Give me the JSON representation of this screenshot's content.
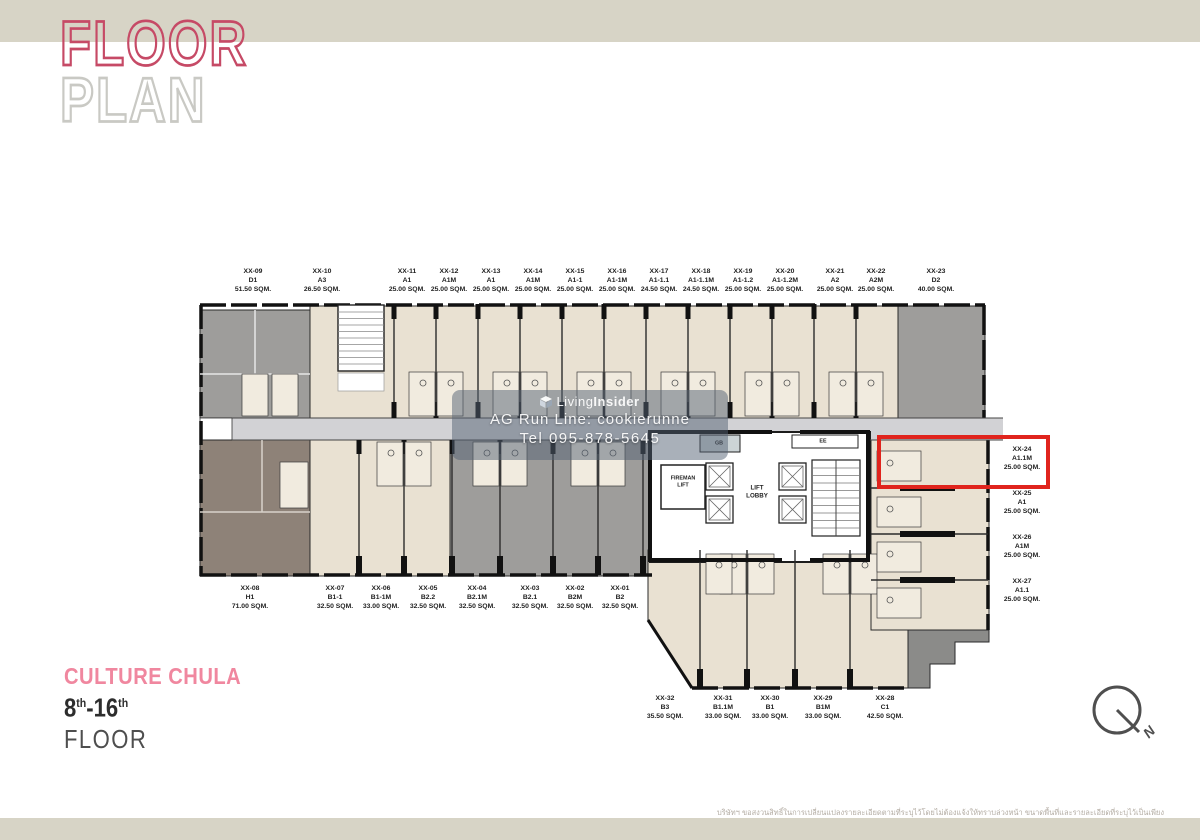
{
  "header": {
    "title_line1": "FLOOR",
    "title_line2": "PLAN"
  },
  "project": {
    "name": "CULTURE CHULA",
    "floor_from": "8",
    "floor_from_sup": "th",
    "floor_to": "-16",
    "floor_to_sup": "th",
    "floor_word": "FLOOR"
  },
  "watermark": {
    "brand_prefix": "Living",
    "brand_suffix": "Insider",
    "line2": "AG Run Line: cookierunne",
    "line3": "Tel 095-878-5645"
  },
  "compass": {
    "label": "N"
  },
  "core": {
    "gb": "GB",
    "ee": "EE",
    "fireman_line1": "FIREMAN",
    "fireman_line2": "LIFT",
    "lobby_line1": "LIFT",
    "lobby_line2": "LOBBY"
  },
  "highlight": {
    "unit": "XX-24",
    "color": "#e0241d"
  },
  "units": {
    "top": [
      {
        "id": "XX-09",
        "type": "D1",
        "area": "51.50 SQM."
      },
      {
        "id": "XX-10",
        "type": "A3",
        "area": "26.50 SQM."
      },
      {
        "id": "XX-11",
        "type": "A1",
        "area": "25.00 SQM."
      },
      {
        "id": "XX-12",
        "type": "A1M",
        "area": "25.00 SQM."
      },
      {
        "id": "XX-13",
        "type": "A1",
        "area": "25.00 SQM."
      },
      {
        "id": "XX-14",
        "type": "A1M",
        "area": "25.00 SQM."
      },
      {
        "id": "XX-15",
        "type": "A1-1",
        "area": "25.00 SQM."
      },
      {
        "id": "XX-16",
        "type": "A1-1M",
        "area": "25.00 SQM."
      },
      {
        "id": "XX-17",
        "type": "A1-1.1",
        "area": "24.50 SQM."
      },
      {
        "id": "XX-18",
        "type": "A1-1.1M",
        "area": "24.50 SQM."
      },
      {
        "id": "XX-19",
        "type": "A1-1.2",
        "area": "25.00 SQM."
      },
      {
        "id": "XX-20",
        "type": "A1-1.2M",
        "area": "25.00 SQM."
      },
      {
        "id": "XX-21",
        "type": "A2",
        "area": "25.00 SQM."
      },
      {
        "id": "XX-22",
        "type": "A2M",
        "area": "25.00 SQM."
      },
      {
        "id": "XX-23",
        "type": "D2",
        "area": "40.00 SQM."
      }
    ],
    "bottom": [
      {
        "id": "XX-08",
        "type": "H1",
        "area": "71.00 SQM."
      },
      {
        "id": "XX-07",
        "type": "B1-1",
        "area": "32.50 SQM."
      },
      {
        "id": "XX-06",
        "type": "B1-1M",
        "area": "33.00 SQM."
      },
      {
        "id": "XX-05",
        "type": "B2.2",
        "area": "32.50 SQM."
      },
      {
        "id": "XX-04",
        "type": "B2.1M",
        "area": "32.50 SQM."
      },
      {
        "id": "XX-03",
        "type": "B2.1",
        "area": "32.50 SQM."
      },
      {
        "id": "XX-02",
        "type": "B2M",
        "area": "32.50 SQM."
      },
      {
        "id": "XX-01",
        "type": "B2",
        "area": "32.50 SQM."
      }
    ],
    "lower": [
      {
        "id": "XX-32",
        "type": "B3",
        "area": "35.50 SQM."
      },
      {
        "id": "XX-31",
        "type": "B1.1M",
        "area": "33.00 SQM."
      },
      {
        "id": "XX-30",
        "type": "B1",
        "area": "33.00 SQM."
      },
      {
        "id": "XX-29",
        "type": "B1M",
        "area": "33.00 SQM."
      },
      {
        "id": "XX-28",
        "type": "C1",
        "area": "42.50 SQM."
      }
    ],
    "right": [
      {
        "id": "XX-24",
        "type": "A1.1M",
        "area": "25.00 SQM."
      },
      {
        "id": "XX-25",
        "type": "A1",
        "area": "25.00 SQM."
      },
      {
        "id": "XX-26",
        "type": "A1M",
        "area": "25.00 SQM."
      },
      {
        "id": "XX-27",
        "type": "A1.1",
        "area": "25.00 SQM."
      }
    ]
  },
  "disclaimer": {
    "line1": "บริษัทฯ ขอสงวนสิทธิ์ในการเปลี่ยนแปลงรายละเอียดตามที่ระบุไว้โดยไม่ต้องแจ้งให้ทราบล่วงหน้า ขนาดพื้นที่และรายละเอียดที่ระบุไว้เป็นเพียง",
    "line2": "การประมาณการ ซึ่งรูปแบบการจัดวางเฟอร์นิเจอร์และการแบ่งสัดส่วนพื้นที่อาจมีการเปลี่ยนแปลงได้ตามความเหมาะสม เป็นเพียงภาพจำลองเพื่อการโฆษณา",
    "line3": "วางพื้นที่ใช้สอย และเพื่อการตกแต่งเท่านั้น"
  },
  "colors": {
    "accent_pink": "#f0879f",
    "title_outline_pink": "#c64a66",
    "beige_unit": "#e9e1d2",
    "gray_unit": "#9e9d9b",
    "brown_unit": "#8e8278",
    "corridor": "#d2d2d5",
    "highlight_red": "#e0241d",
    "band": "#d7d4c6"
  }
}
